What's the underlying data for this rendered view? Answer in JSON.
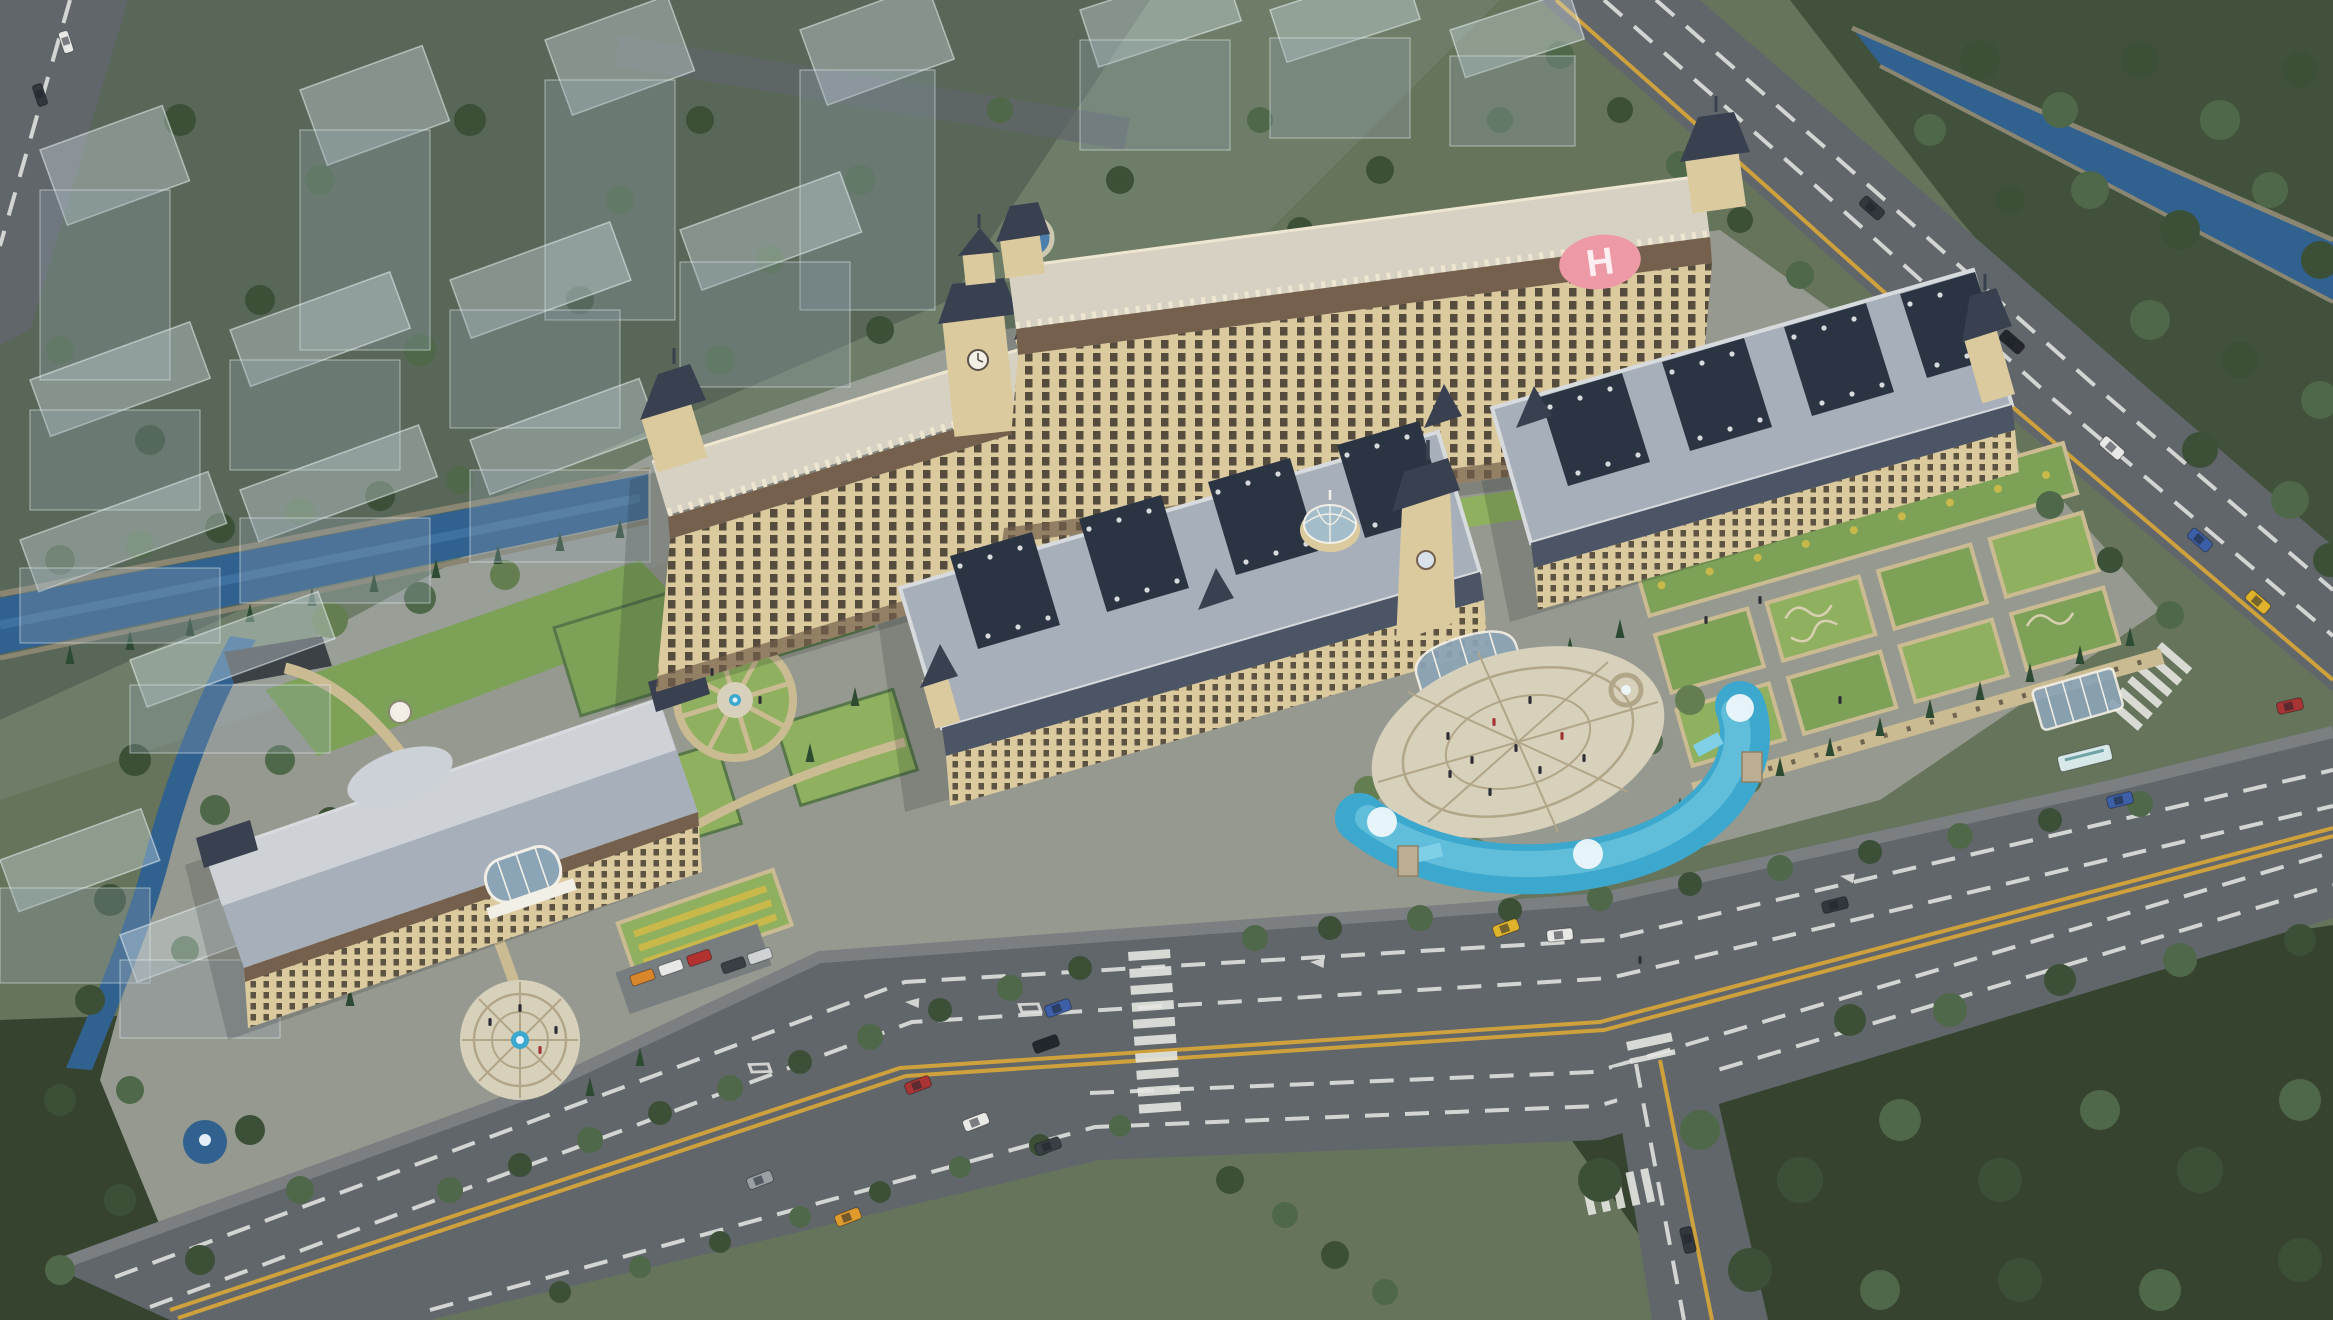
{
  "scene": {
    "type": "aerial-architectural-rendering",
    "site": "classical-palace-style-medical-campus",
    "helipad": {
      "letter": "H"
    }
  },
  "palette": {
    "bg": "#66745c",
    "bgDark": "#4e5c4a",
    "forest": "#41513b",
    "forestDark": "#36432f",
    "road": "#61666b",
    "roadSide": "#7b7f82",
    "laneWhite": "#e8e9e4",
    "laneYellow": "#cfa13d",
    "pavement": "#96998f",
    "path": "#cabb92",
    "plaza": "#d7d0bb",
    "plazaRing": "#b2a688",
    "lawn": "#7ca157",
    "lawnBright": "#8fb05e",
    "lawnBand": "#b9ce60",
    "hedge": "#57774a",
    "treeDark": "#3c5038",
    "treeMid": "#50684a",
    "treeLight": "#647e52",
    "cypress": "#2d4b33",
    "canal": "#30618f",
    "canalLight": "#4a7fae",
    "stone": "#8b8672",
    "facade": "#dcca9f",
    "facadeShade": "#c9b388",
    "cornice": "#74604c",
    "windowDark": "#463e33",
    "roofDeck": "#d6d1c2",
    "parapet": "#eee6d0",
    "slate": "#a7b0ba",
    "slateLight": "#d8dbde",
    "slateDark": "#4c5565",
    "mansard": "#394150",
    "courtyard": "#2b3442",
    "dome": "#a3bdcb",
    "glass": "#8ba4b6",
    "white": "#f2efe6",
    "helipad": "#ee9aa6",
    "pool": "#3da8cd",
    "poolLight": "#7fd0e6",
    "fountain": "#eef7fb",
    "ghostTop": "rgba(214,226,232,0.36)",
    "ghostSide": "rgba(147,163,175,0.30)",
    "ghostStroke": "rgba(243,250,252,0.5)",
    "shadow": "rgba(18,24,30,0.17)",
    "carDark": "#32373e",
    "busBody": "#d7e8e9"
  },
  "vehicles": {
    "cars": [
      {
        "color": "#e09b2d"
      },
      {
        "color": "#a83434"
      },
      {
        "color": "#e8e9e6"
      },
      {
        "color": "#3a3f46"
      },
      {
        "color": "#24282e"
      },
      {
        "color": "#3d5fa8"
      },
      {
        "color": "#9aa0a4"
      },
      {
        "color": "#e8e9e6"
      },
      {
        "color": "#32373e"
      },
      {
        "color": "#3d5fa8"
      },
      {
        "color": "#a83434"
      },
      {
        "color": "#32373e"
      },
      {
        "color": "#24282e"
      },
      {
        "color": "#e8e9e6"
      },
      {
        "color": "#3d5fa8"
      },
      {
        "color": "#e0b32d"
      },
      {
        "color": "#32373e"
      },
      {
        "color": "#e8e9e6"
      },
      {
        "color": "#e0b32d"
      },
      {
        "color": "#32373e"
      }
    ],
    "bus": {
      "color": "#d7e8e9"
    }
  }
}
